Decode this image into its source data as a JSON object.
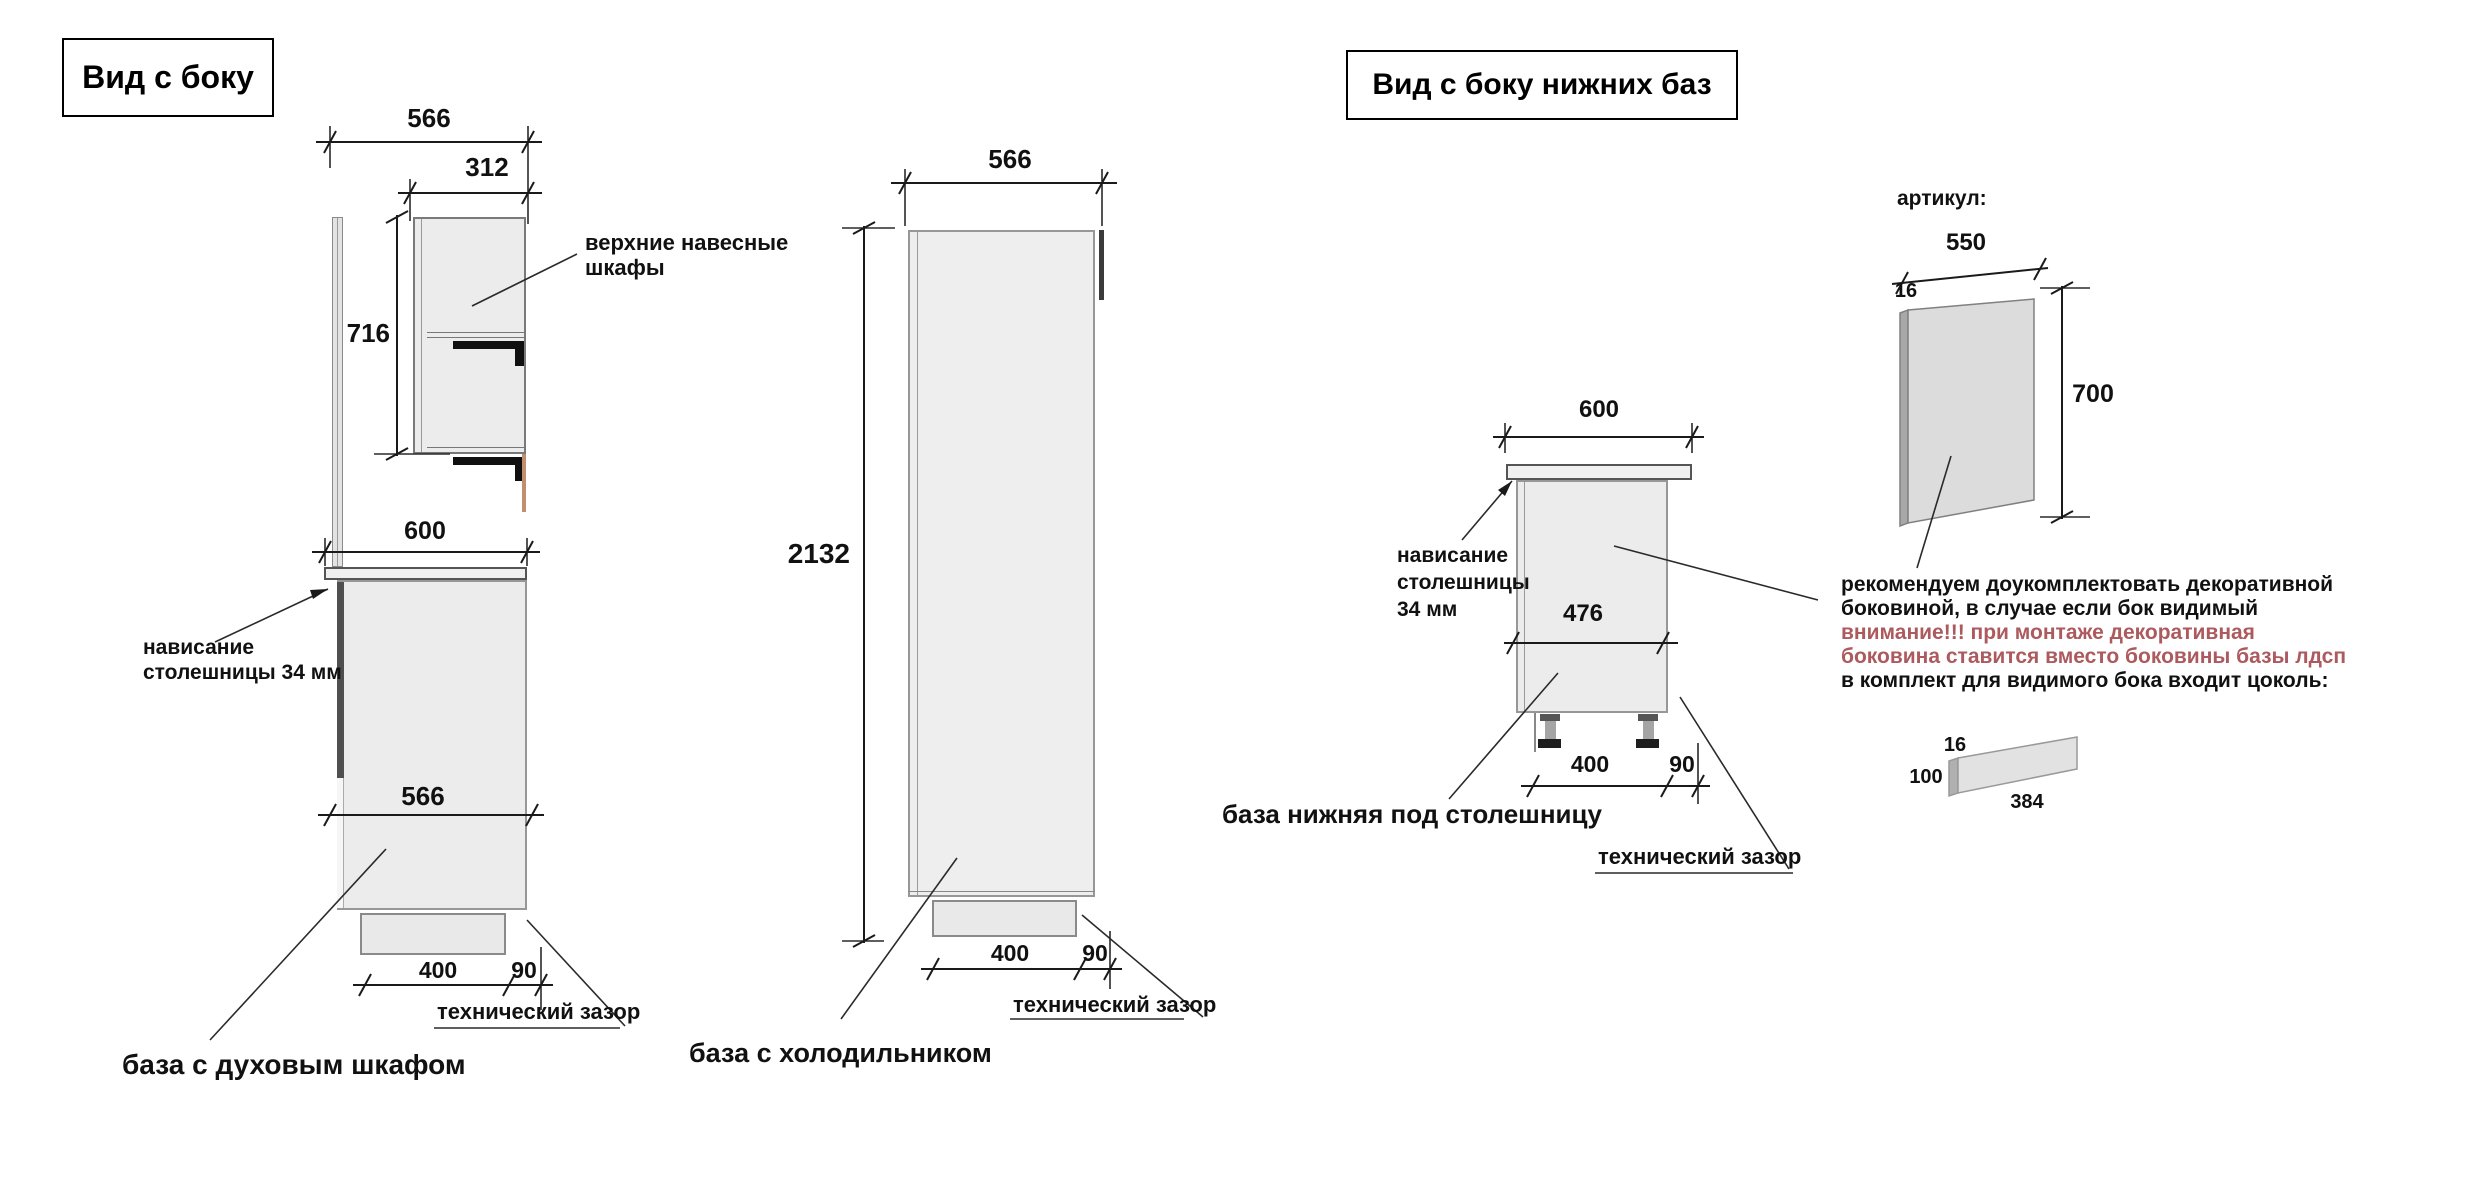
{
  "left_view": {
    "title": "Вид с боку",
    "dims": {
      "top_depth": "566",
      "upper_depth": "312",
      "upper_height": "716",
      "counter_depth": "600",
      "base_depth": "566",
      "plinth_inset": "400",
      "tech_gap": "90"
    },
    "labels": {
      "upper_cabinets_line1": "верхние навесные",
      "upper_cabinets_line2": "шкафы",
      "overhang_line1": "нависание",
      "overhang_line2": "столешницы 34 мм",
      "tech_gap": "технический зазор",
      "caption": "база с духовым шкафом"
    }
  },
  "middle_view": {
    "dims": {
      "top_depth": "566",
      "height": "2132",
      "plinth_inset": "400",
      "tech_gap": "90"
    },
    "labels": {
      "tech_gap": "технический зазор",
      "caption": "база с холодильником"
    }
  },
  "right_view": {
    "title": "Вид с боку нижних баз",
    "base": {
      "dims": {
        "counter_depth": "600",
        "inner_height": "476",
        "plinth_inset": "400",
        "tech_gap": "90"
      },
      "labels": {
        "overhang_line1": "нависание",
        "overhang_line2": "столешницы",
        "overhang_line3": "34 мм",
        "tech_gap": "технический зазор",
        "caption": "база нижняя под столешницу"
      }
    },
    "side_panel": {
      "article": "артикул:",
      "dims": {
        "width": "550",
        "thickness": "16",
        "height": "700"
      }
    },
    "note": {
      "lines": [
        "рекомендуем доукомплектовать декоративной",
        "боковиной, в случае если бок видимый",
        "внимание!!! при монтаже декоративная",
        "боковина ставится вместо боковины базы лдсп",
        "в комплект для видимого бока входит цоколь:"
      ]
    },
    "plinth_piece": {
      "dims": {
        "thickness": "16",
        "height": "100",
        "length": "384"
      }
    }
  },
  "colors": {
    "warning_text": "#ac5a5e",
    "drawing_line": "#1a1a1a"
  }
}
